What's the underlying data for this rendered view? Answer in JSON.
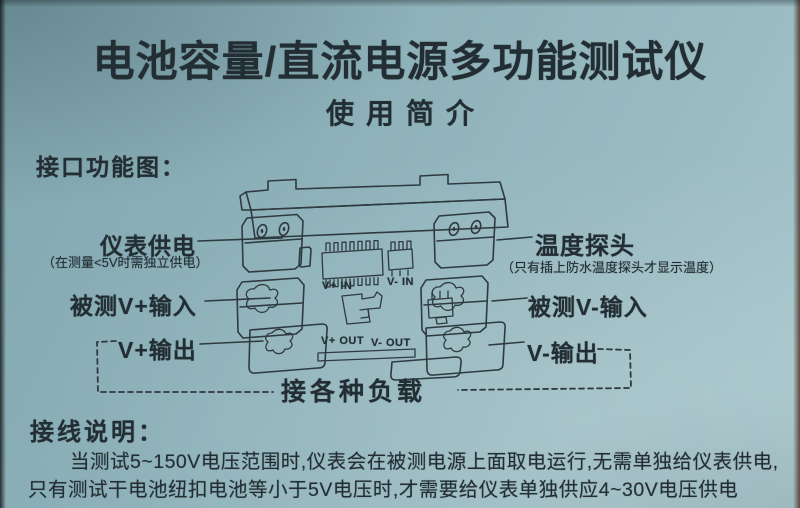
{
  "page": {
    "title": "电池容量/直流电源多功能测试仪",
    "subtitle": "使用简介"
  },
  "diagram": {
    "heading": "接口功能图：",
    "labels": {
      "meter_power": "仪表供电",
      "meter_power_note": "（在测量<5V时需独立供电）",
      "v_plus_input": "被测V+输入",
      "v_plus_output": "V+输出",
      "temp_probe": "温度探头",
      "temp_probe_note": "（只有插上防水温度探头才显示温度）",
      "v_minus_input": "被测V-输入",
      "v_minus_output": "V-输出",
      "load": "接各种负载"
    },
    "device_markings": {
      "v_plus_in": "V+ IN",
      "v_minus_in": "V- IN",
      "v_plus_out": "V+ OUT",
      "v_minus_out": "V- OUT"
    }
  },
  "wiring_notes": {
    "heading": "接线说明：",
    "lines": [
      "当测试5~150V电压范围时,仪表会在被测电源上面取电运行,无需单独给仪表供电,",
      "只有测试干电池纽扣电池等小于5V电压时,才需要给仪表单独供应4~30V电压供电"
    ]
  },
  "colors": {
    "paper": "#8fb3bb",
    "ink": "#222e34",
    "line": "#2e3a40"
  }
}
